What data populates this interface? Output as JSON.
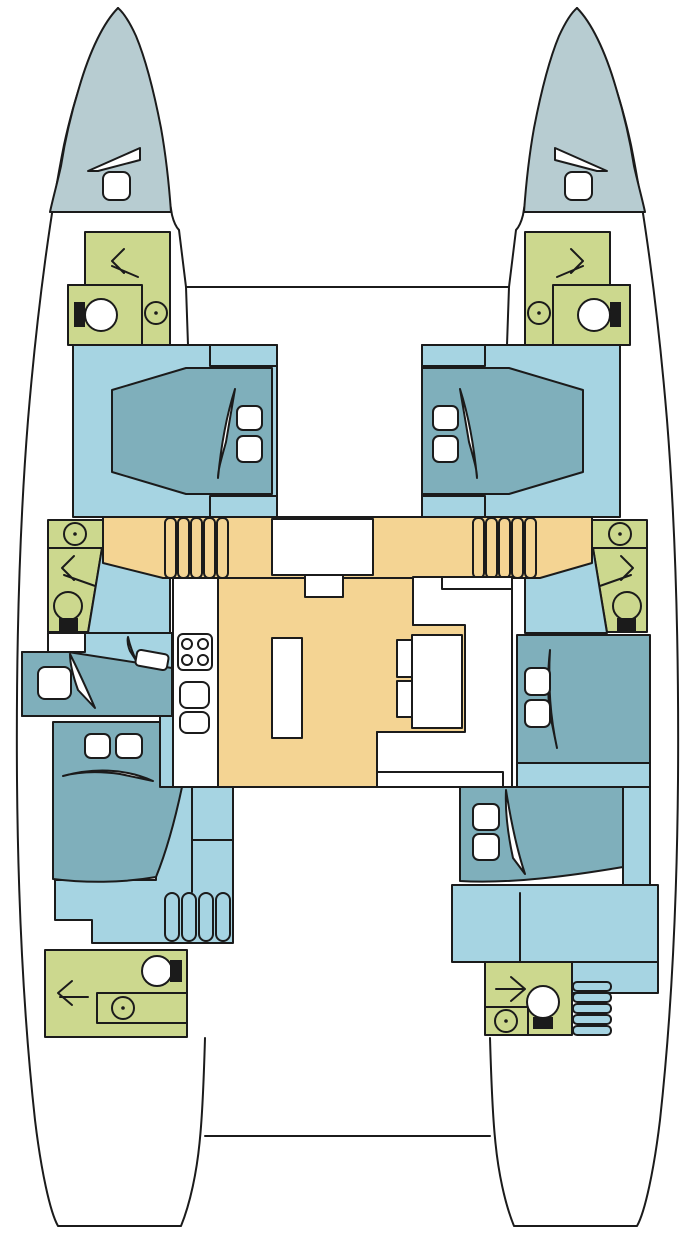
{
  "title": "Catamaran interior deck plan (top view)",
  "canvas": {
    "width": 695,
    "height": 1239
  },
  "palette": {
    "line": "#1b1b1b",
    "hull": "#ffffff",
    "bow": "#b7ccd1",
    "cabin": "#a6d4e2",
    "bed": "#7fafbb",
    "head": "#ccd88e",
    "salon": "#f4d493",
    "furniture": "#ffffff"
  },
  "legend": {
    "hulls": [
      "port-hull",
      "starboard-hull"
    ],
    "bridge": [
      "forward-crossbeam",
      "aft-crossbeam",
      "salon-cockpit"
    ],
    "rooms": [
      {
        "id": "port-bow-locker",
        "fixtures": [
          "deck-hatch",
          "locker-lid"
        ]
      },
      {
        "id": "starboard-bow-locker",
        "fixtures": [
          "deck-hatch",
          "locker-lid"
        ]
      },
      {
        "id": "port-forward-head",
        "fixtures": [
          "shower-arrow",
          "toilet",
          "sink"
        ]
      },
      {
        "id": "starboard-forward-head",
        "fixtures": [
          "shower-arrow",
          "toilet",
          "sink"
        ]
      },
      {
        "id": "port-forward-cabin",
        "fixtures": [
          "double-bed",
          "pillow",
          "pillow",
          "blanket-accent",
          "wardrobe",
          "wardrobe"
        ]
      },
      {
        "id": "starboard-forward-cabin",
        "fixtures": [
          "double-bed",
          "pillow",
          "pillow",
          "blanket-accent",
          "wardrobe",
          "wardrobe"
        ]
      },
      {
        "id": "port-mid-head",
        "fixtures": [
          "sink",
          "shower-arrow",
          "toilet"
        ]
      },
      {
        "id": "starboard-mid-head",
        "fixtures": [
          "sink",
          "shower-arrow",
          "toilet"
        ]
      },
      {
        "id": "salon",
        "fixtures": [
          "port-companionway-stairs",
          "starboard-companionway-stairs",
          "nav-station",
          "nav-seat",
          "galley-counter",
          "stove",
          "galley-sink",
          "galley-sink",
          "island-counter",
          "dinette-bench",
          "dinette-table",
          "dinette-seat",
          "dinette-seat"
        ]
      },
      {
        "id": "port-mid-cabin",
        "fixtures": [
          "bed",
          "pillow",
          "cabinet",
          "blanket-accent"
        ]
      },
      {
        "id": "starboard-mid-cabin",
        "fixtures": [
          "bed",
          "pillow",
          "pillow",
          "blanket-accent"
        ]
      },
      {
        "id": "port-aft-cabin",
        "fixtures": [
          "double-bed",
          "pillow",
          "pillow",
          "blanket-accent",
          "aft-stairs"
        ]
      },
      {
        "id": "starboard-aft-cabin",
        "fixtures": [
          "double-bed",
          "pillow",
          "pillow",
          "blanket-accent",
          "aft-stairs"
        ]
      },
      {
        "id": "port-aft-head",
        "fixtures": [
          "toilet",
          "shower-arrow",
          "vanity-counter",
          "sink"
        ]
      },
      {
        "id": "starboard-aft-head",
        "fixtures": [
          "shower-arrow",
          "toilet",
          "sink"
        ]
      }
    ]
  }
}
